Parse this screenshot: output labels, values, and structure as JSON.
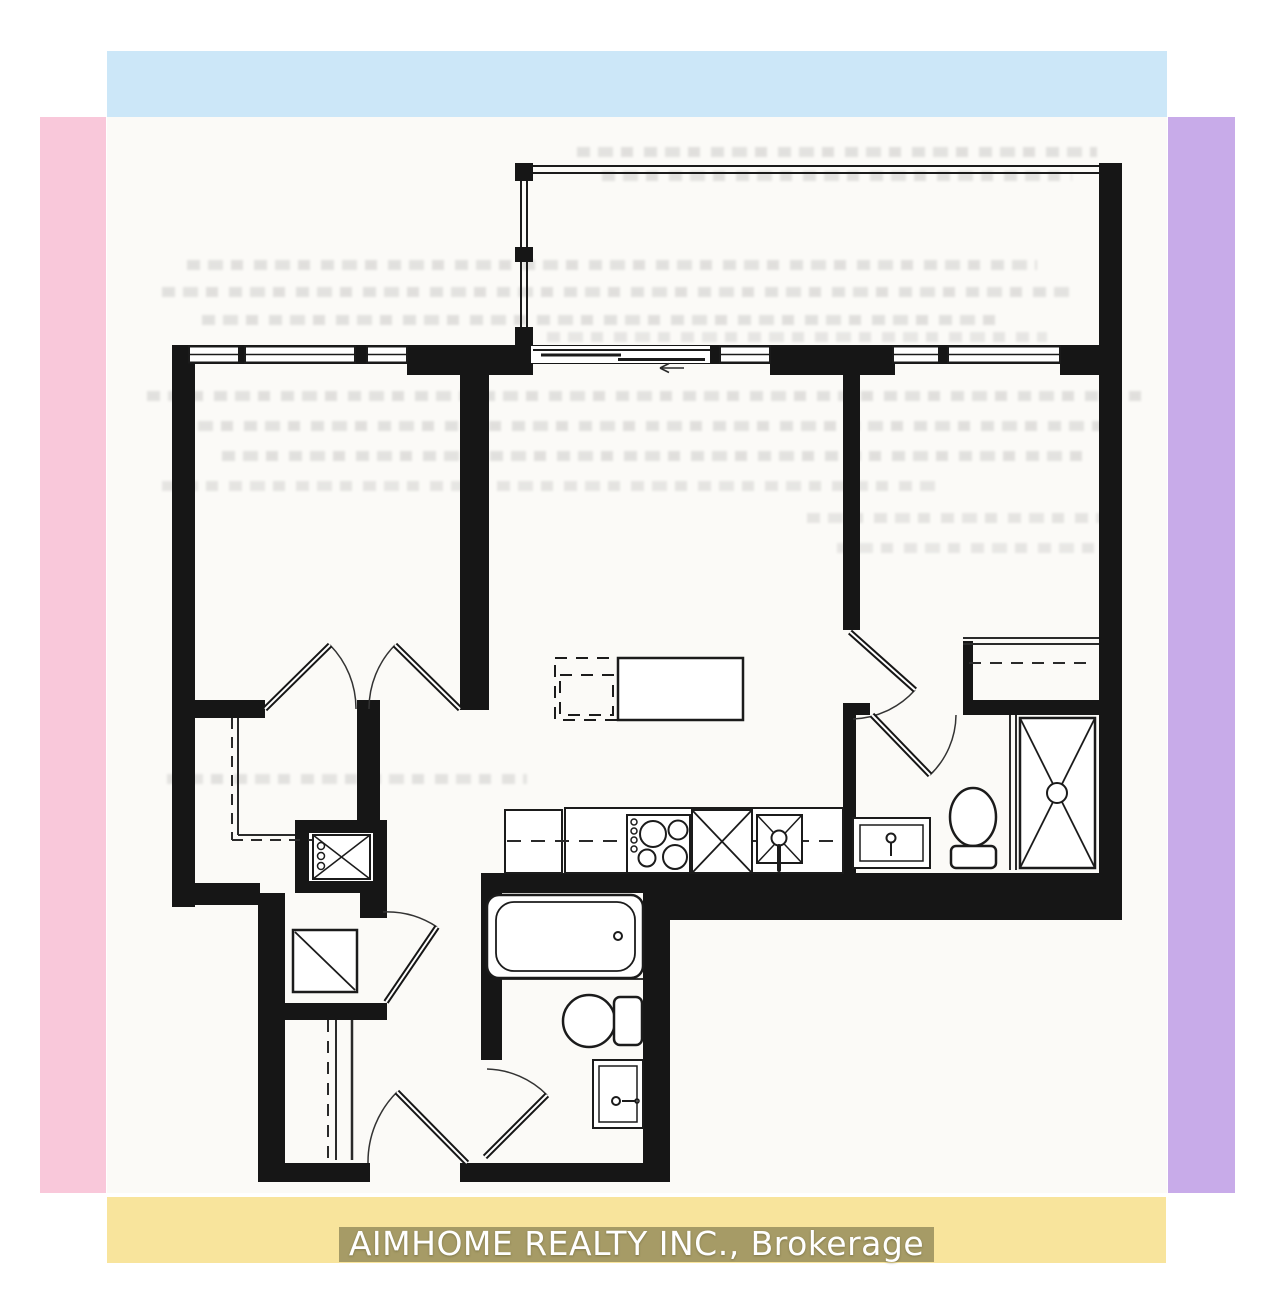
{
  "footer": {
    "brand": "AIMHOME REALTY INC., Brokerage"
  },
  "theme": {
    "strip-top": "#cce7f8",
    "strip-left": "#f9c8da",
    "strip-right": "#c8abe9",
    "strip-bottom": "#f8e49c",
    "plan-bg": "#fbfaf7",
    "wall": "#161616",
    "line": "#1b1b1b",
    "footer-text": "#ffffff",
    "footer-highlight": "rgba(99,95,58,0.55)"
  }
}
